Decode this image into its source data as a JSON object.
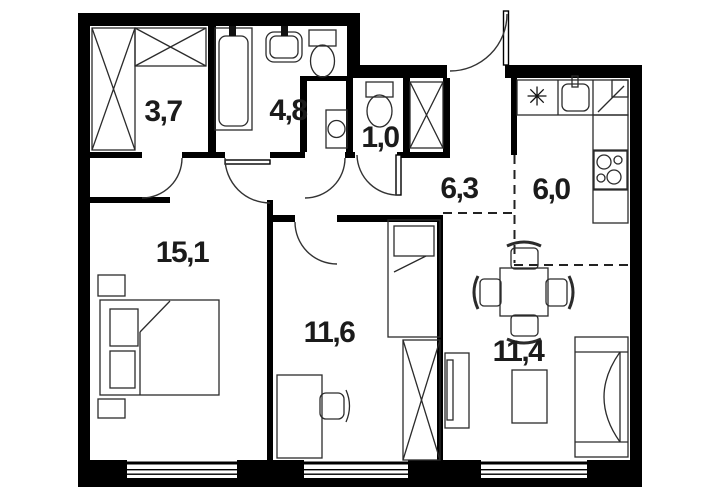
{
  "plan": {
    "type": "apartment-floor-plan",
    "rooms": [
      {
        "name": "wardrobe",
        "area": "3,7"
      },
      {
        "name": "bathroom",
        "area": "4,8"
      },
      {
        "name": "wc",
        "area": "1,0"
      },
      {
        "name": "hallway",
        "area": "6,3"
      },
      {
        "name": "kitchen",
        "area": "6,0"
      },
      {
        "name": "bedroom",
        "area": "15,1"
      },
      {
        "name": "bedroom-2",
        "area": "11,6"
      },
      {
        "name": "living-room",
        "area": "11,4"
      }
    ],
    "symbols": {
      "kitchen_marker": "✳"
    },
    "colors": {
      "wall": "#000000",
      "line": "#2b2b2b",
      "background": "#ffffff"
    }
  }
}
